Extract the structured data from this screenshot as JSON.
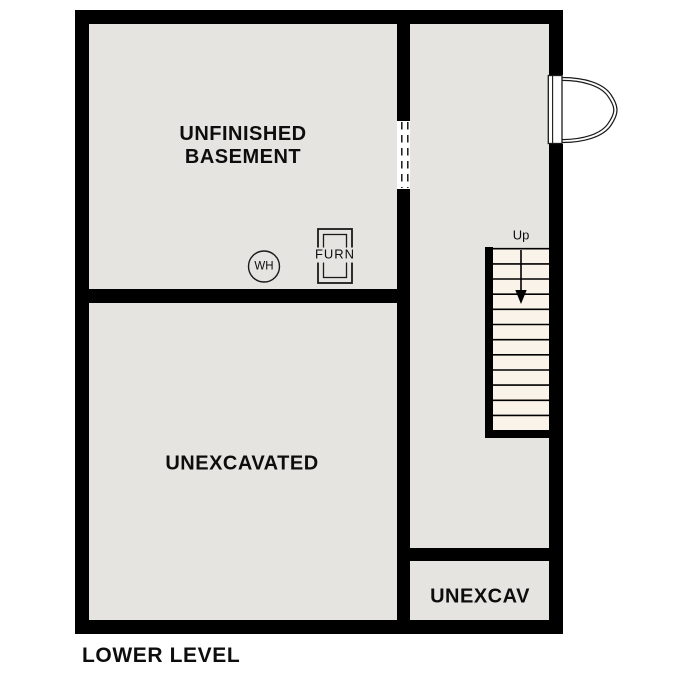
{
  "title": "LOWER LEVEL",
  "colors": {
    "wall": "#000000",
    "room_fill": "#e5e4e1",
    "stair_fill": "#faf3e9",
    "background": "#ffffff",
    "line": "#1a1a1a"
  },
  "rooms": {
    "unfinished_basement": {
      "label": "UNFINISHED\nBASEMENT"
    },
    "unexcavated": {
      "label": "UNEXCAVATED"
    },
    "unexcav": {
      "label": "UNEXCAV"
    }
  },
  "fixtures": {
    "water_heater": {
      "label": "WH"
    },
    "furnace": {
      "label": "FURN"
    }
  },
  "stairs": {
    "direction_label": "Up",
    "tread_count": 12
  }
}
